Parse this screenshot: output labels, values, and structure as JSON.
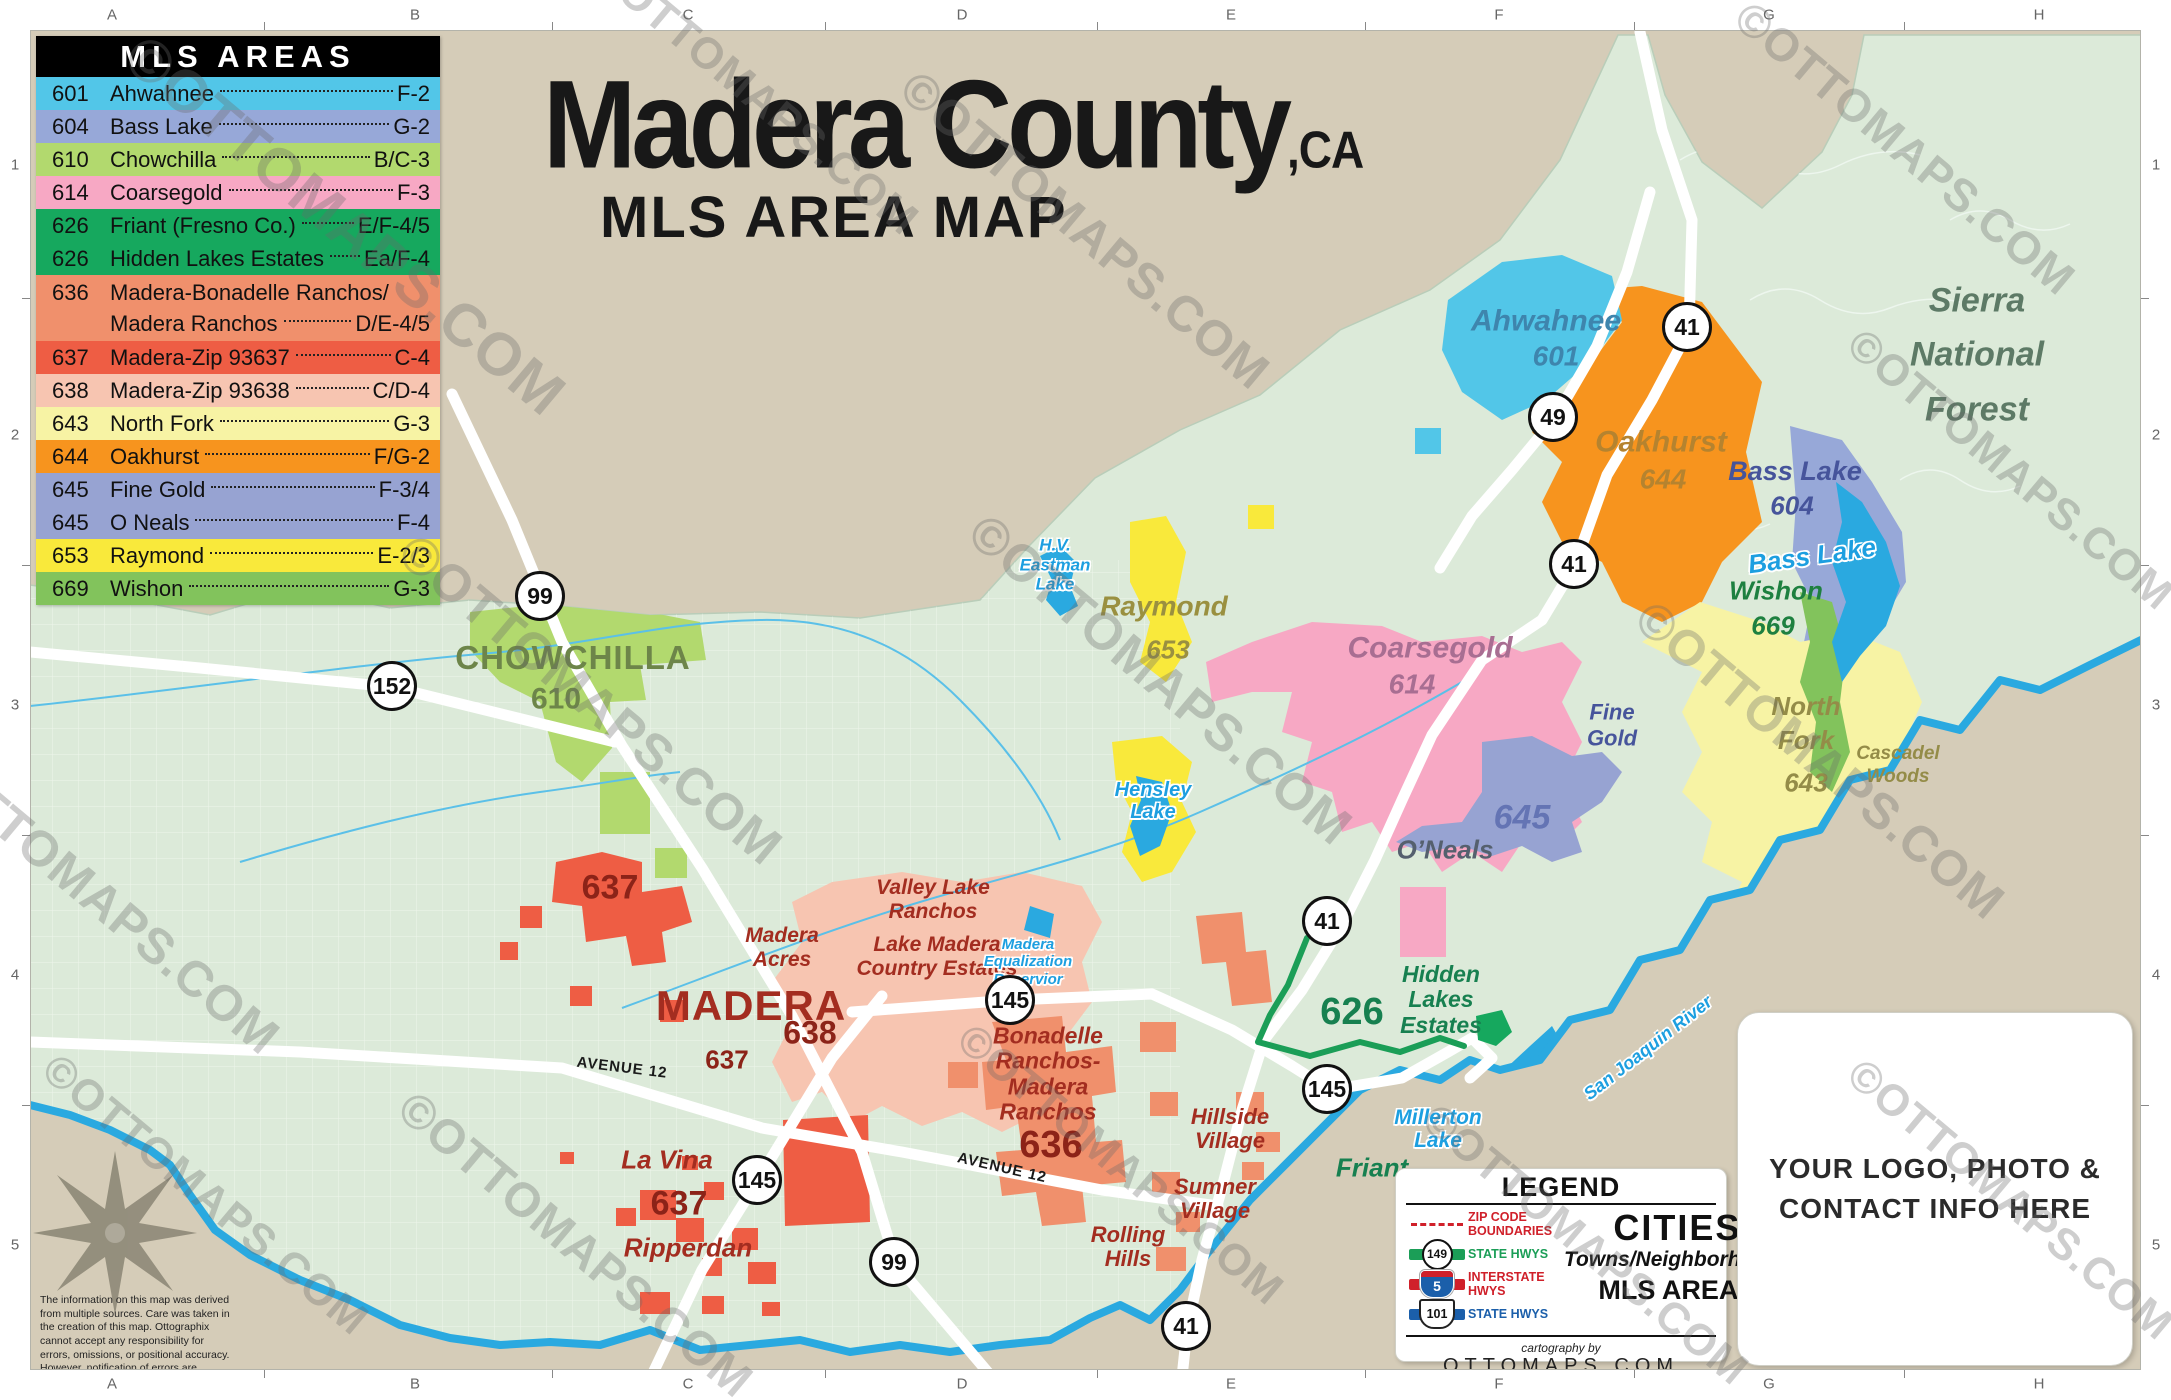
{
  "title": {
    "main": "Madera County",
    "suffix": ",CA",
    "subtitle": "MLS AREA MAP"
  },
  "watermark": "©OTTOMAPS.COM",
  "grid": {
    "cols": [
      "A",
      "B",
      "C",
      "D",
      "E",
      "F",
      "G",
      "H"
    ],
    "rows": [
      "1",
      "2",
      "3",
      "4",
      "5"
    ]
  },
  "mls_panel": {
    "title": "MLS AREAS",
    "rows": [
      {
        "code": "601",
        "name": "Ahwahnee",
        "ref": "F-2",
        "color": "#52c6e8"
      },
      {
        "code": "604",
        "name": "Bass Lake",
        "ref": "G-2",
        "color": "#97a8d8"
      },
      {
        "code": "610",
        "name": "Chowchilla",
        "ref": "B/C-3",
        "color": "#b2d96e"
      },
      {
        "code": "614",
        "name": "Coarsegold",
        "ref": "F-3",
        "color": "#f7a8c4"
      },
      {
        "code": "626",
        "name": "Friant (Fresno Co.)",
        "ref": "E/F-4/5",
        "color": "#16a85e"
      },
      {
        "code": "626",
        "name": "Hidden Lakes Estates",
        "ref": "Ea/F-4",
        "color": "#16a85e"
      },
      {
        "code": "636",
        "name": "Madera-Bonadelle Ranchos/",
        "name2": "Madera Ranchos",
        "ref": "D/E-4/5",
        "color": "#f0906c"
      },
      {
        "code": "637",
        "name": "Madera-Zip 93637",
        "ref": "C-4",
        "color": "#ee5d44"
      },
      {
        "code": "638",
        "name": "Madera-Zip 93638",
        "ref": "C/D-4",
        "color": "#f7c5b1"
      },
      {
        "code": "643",
        "name": "North Fork",
        "ref": "G-3",
        "color": "#f7f3a4"
      },
      {
        "code": "644",
        "name": "Oakhurst",
        "ref": "F/G-2",
        "color": "#f7941e"
      },
      {
        "code": "645",
        "name": "Fine Gold",
        "ref": "F-3/4",
        "color": "#97a3d2"
      },
      {
        "code": "645",
        "name": "O Neals",
        "ref": "F-4",
        "color": "#97a3d2"
      },
      {
        "code": "653",
        "name": "Raymond",
        "ref": "E-2/3",
        "color": "#f9e93b"
      },
      {
        "code": "669",
        "name": "Wishon",
        "ref": "G-3",
        "color": "#82c35c"
      }
    ]
  },
  "map": {
    "forest": {
      "line1": "Sierra",
      "line2": "National",
      "line3": "Forest"
    },
    "regions": {
      "chowchilla": {
        "name": "CHOWCHILLA",
        "code": "610"
      },
      "ahwahnee": {
        "name": "Ahwahnee",
        "code": "601"
      },
      "oakhurst": {
        "name": "Oakhurst",
        "code": "644"
      },
      "bass_lake": {
        "name": "Bass Lake",
        "code": "604"
      },
      "wishon": {
        "name": "Wishon",
        "code": "669"
      },
      "north_fork": {
        "line1": "North",
        "line2": "Fork",
        "code": "643"
      },
      "cascadel": {
        "line1": "Cascadel",
        "line2": "Woods"
      },
      "raymond": {
        "name": "Raymond",
        "code": "653"
      },
      "coarsegold": {
        "name": "Coarsegold",
        "code": "614"
      },
      "fine_gold": {
        "line1": "Fine",
        "line2": "Gold"
      },
      "area645": {
        "code": "645"
      },
      "oneals": {
        "name": "O’Neals"
      },
      "madera": {
        "name": "MADERA",
        "code": "638"
      },
      "code637": "637",
      "madera_acres": {
        "line1": "Madera",
        "line2": "Acres"
      },
      "valley_lake": {
        "line1": "Valley Lake",
        "line2": "Ranchos"
      },
      "lake_madera": {
        "line1": "Lake Madera",
        "line2": "Country Estates"
      },
      "la_vina": {
        "name": "La Vina",
        "code": "637",
        "sub": "Ripperdan"
      },
      "bonadelle": {
        "line1": "Bonadelle",
        "line2": "Ranchos-",
        "line3": "Madera",
        "line4": "Ranchos",
        "code": "636"
      },
      "hidden_lakes": {
        "code": "626",
        "line1": "Hidden",
        "line2": "Lakes",
        "line3": "Estates"
      },
      "hillside": {
        "line1": "Hillside",
        "line2": "Village"
      },
      "sumner": {
        "line1": "Sumner",
        "line2": "Village"
      },
      "rolling": {
        "line1": "Rolling",
        "line2": "Hills"
      },
      "friant": {
        "name": "Friant"
      }
    },
    "lakes": {
      "millerton": {
        "line1": "Millerton",
        "line2": "Lake"
      },
      "hensley": {
        "line1": "Hensley",
        "line2": "Lake"
      },
      "eastman": {
        "line1": "H.V.",
        "line2": "Eastman",
        "line3": "Lake"
      },
      "madera_eq": {
        "line1": "Madera",
        "line2": "Equalization",
        "line3": "Reservior"
      },
      "bass": {
        "name": "Bass Lake"
      }
    },
    "river_label": "San Joaquin River",
    "avenue12": "AVENUE 12",
    "shields": [
      {
        "number": "99"
      },
      {
        "number": "99"
      },
      {
        "number": "152"
      },
      {
        "number": "145"
      },
      {
        "number": "145"
      },
      {
        "number": "145"
      },
      {
        "number": "41"
      },
      {
        "number": "41"
      },
      {
        "number": "41"
      },
      {
        "number": "41"
      },
      {
        "number": "49"
      }
    ]
  },
  "legend_box": {
    "title": "LEGEND",
    "zip_label": "ZIP CODE BOUNDARIES",
    "state_hwy_green": {
      "shield": "149",
      "label": "STATE HWYS"
    },
    "interstate": {
      "shield": "5",
      "label": "INTERSTATE HWYS"
    },
    "state_hwy_blue": {
      "shield": "101",
      "label": "STATE HWYS"
    },
    "cities": "CITIES",
    "towns": "Towns/Neighborhoods",
    "mls_areas": "MLS AREAS",
    "cartography": "cartography by",
    "site": "OTTOMAPS.COM"
  },
  "logo_box": {
    "line1": "YOUR LOGO, PHOTO &",
    "line2": "CONTACT INFO HERE"
  },
  "disclaimer": "The information on this map was derived from multiple sources. Care was taken in the creation of this map. Ottographix cannot accept any responsibility for errors, omissions, or positional accuracy. However, notification of errors are appreciated.",
  "colors": {
    "county_fill": "#dcead9",
    "outside_fill": "#d5ccb8",
    "water": "#2aa9e0",
    "hwy_green": "#1b9e57"
  }
}
